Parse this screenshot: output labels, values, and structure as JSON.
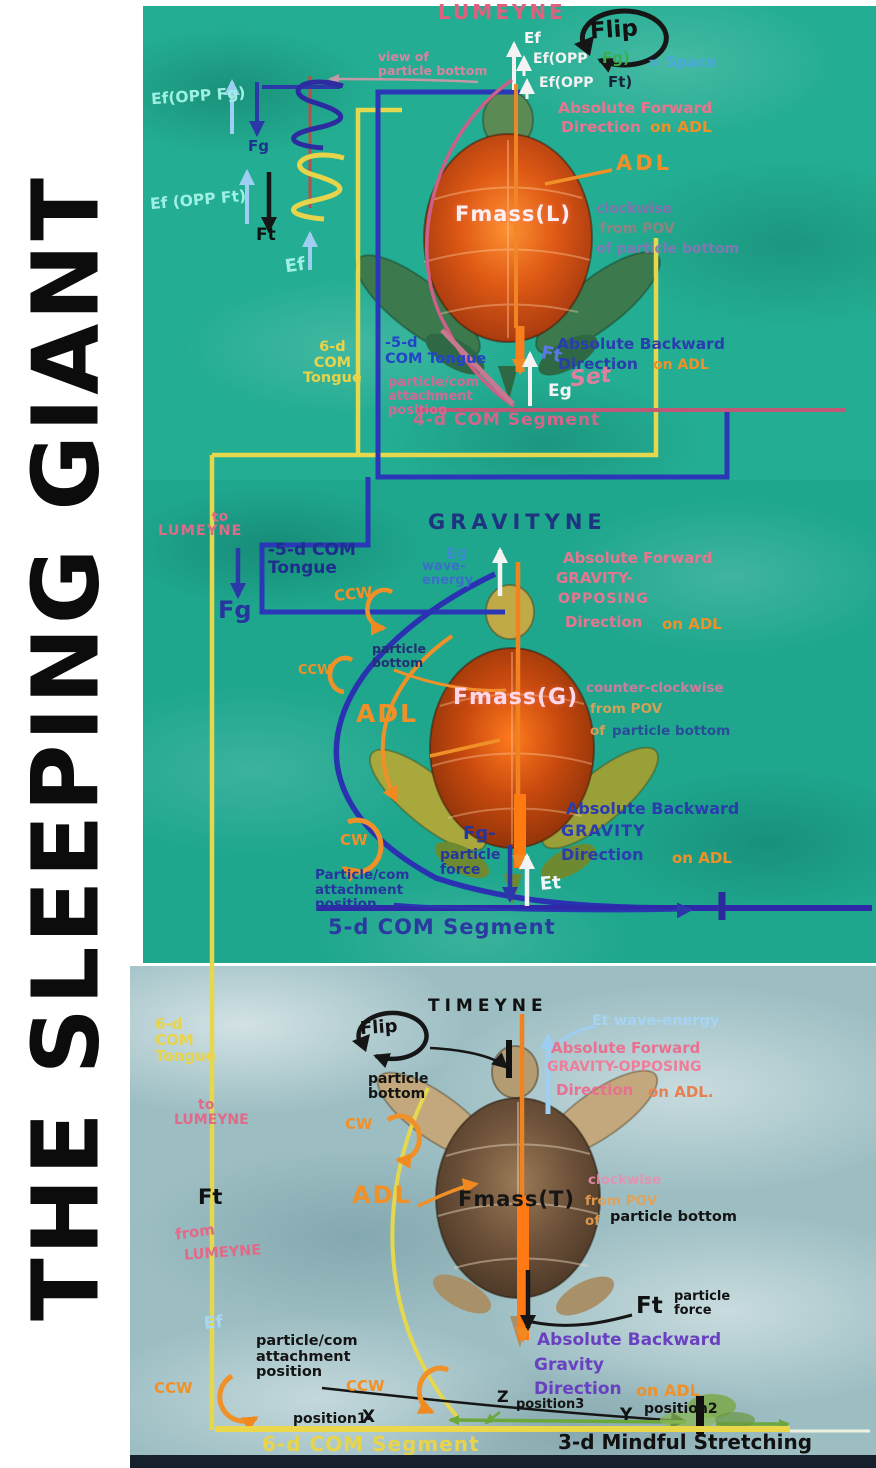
{
  "title": {
    "text": "THE SLEEPING GIANT"
  },
  "colors": {
    "water_top": "#23ad92",
    "water_mid": "#1fa78e",
    "water_bottom": "#9cbec3",
    "pink": "#e06a88",
    "orange": "#f09028",
    "navy": "#26369e",
    "light_blue": "#9ecef2",
    "cyan": "#a0f0e2",
    "yellow": "#e8d84e",
    "purple": "#6840c0",
    "green": "#6aa83c",
    "black": "#141414",
    "white": "#f7f7f7"
  },
  "p1": {
    "heading": "LUMEYNE",
    "flip": "Flip",
    "view_pb": "view of\nparticle bottom",
    "ef_top": "Ef",
    "ef_opp_fg_a": "Ef(OPP",
    "ef_opp_fg_b": "Fg)",
    "eq_space": "= Space",
    "ef_opp_ft_a": "Ef(OPP",
    "ef_opp_ft_b": "Ft)",
    "abs_fwd": "Absolute Forward",
    "dir": "Direction",
    "on_adl": "on ADL",
    "adl": "ADL",
    "fmass": "Fmass(L)",
    "pov1": "clockwise",
    "pov2": "from POV",
    "pov3": "of particle bottom",
    "ef_opp_fg_left": "Ef(OPP Fg)",
    "fg": "Fg",
    "ef_opp_ft_left": "Ef (OPP Ft)",
    "ft": "Ft",
    "ef": "Ef",
    "tongue6": "6-d\nCOM\nTongue",
    "tongue5": "-5-d\nCOM Tongue",
    "attach": "particle/com\nattachment\nposition",
    "ft2": "Ft",
    "abs_bwd": "Absolute Backward",
    "dir2": "Direction",
    "on_adl2": "on ADL",
    "set_word": "Set",
    "eg": "Eg",
    "segment": "4-d COM Segment"
  },
  "p2": {
    "to": "to",
    "lumeyne": "LUMEYNE",
    "fg": "Fg",
    "tongue5": "-5-d COM\nTongue",
    "ccw1": "CCW",
    "heading": "GRAVITYNE",
    "eg": "Eg",
    "wave": "wave-\nenergy",
    "abs_fwd": "Absolute Forward",
    "grav1": "GRAVITY-",
    "grav2": "OPPOSING",
    "dir": "Direction",
    "on_adl": "on ADL",
    "pb": "particle\nbottom",
    "ccw2": "CCW",
    "adl": "ADL",
    "fmass": "Fmass(G)",
    "pov1": "counter-clockwise",
    "pov2": "from POV",
    "pov3": "of",
    "pov4": "particle bottom",
    "cw": "CW",
    "fgp": "Fg-",
    "fgp2": "particle\nforce",
    "abs_bwd": "Absolute Backward",
    "grav": "GRAVITY",
    "dir2": "Direction",
    "on_adl2": "on ADL",
    "et": "Et",
    "attach": "Particle/com\nattachment\nposition",
    "segment": "5-d COM Segment"
  },
  "p3": {
    "tongue6": "6-d\nCOM\nTongue",
    "to": "to",
    "lumeyne": "LUMEYNE",
    "ft": "Ft",
    "from_w": "from",
    "lumeyne2": "LUMEYNE",
    "ef": "Ef",
    "ccw1": "CCW",
    "flip": "Flip",
    "heading": "TIMEYNE",
    "et_wave": "Et wave-energy",
    "abs_fwd": "Absolute Forward",
    "grav": "GRAVITY-OPPOSING",
    "dir": "Direction",
    "on_adl": "on ADL.",
    "pb": "particle\nbottom",
    "cw": "CW",
    "adl": "ADL",
    "fmass": "Fmass(T)",
    "pov1": "clockwise",
    "pov2": "from POV",
    "pov3": "of",
    "pov4": "particle bottom",
    "ftp": "Ft",
    "ftp2": "particle\nforce",
    "abs_bwd": "Absolute Backward",
    "grav2": "Gravity",
    "dir2": "Direction",
    "on_adl2": "on ADL",
    "attach": "particle/com\nattachment\nposition",
    "ccw2": "CCW",
    "z": "Z",
    "pos3": "position3",
    "pos1": "position1-",
    "x": "X",
    "y": "Y",
    "pos2": "position2",
    "segment": "6-d COM Segment",
    "stretch": "3-d Mindful Stretching"
  }
}
